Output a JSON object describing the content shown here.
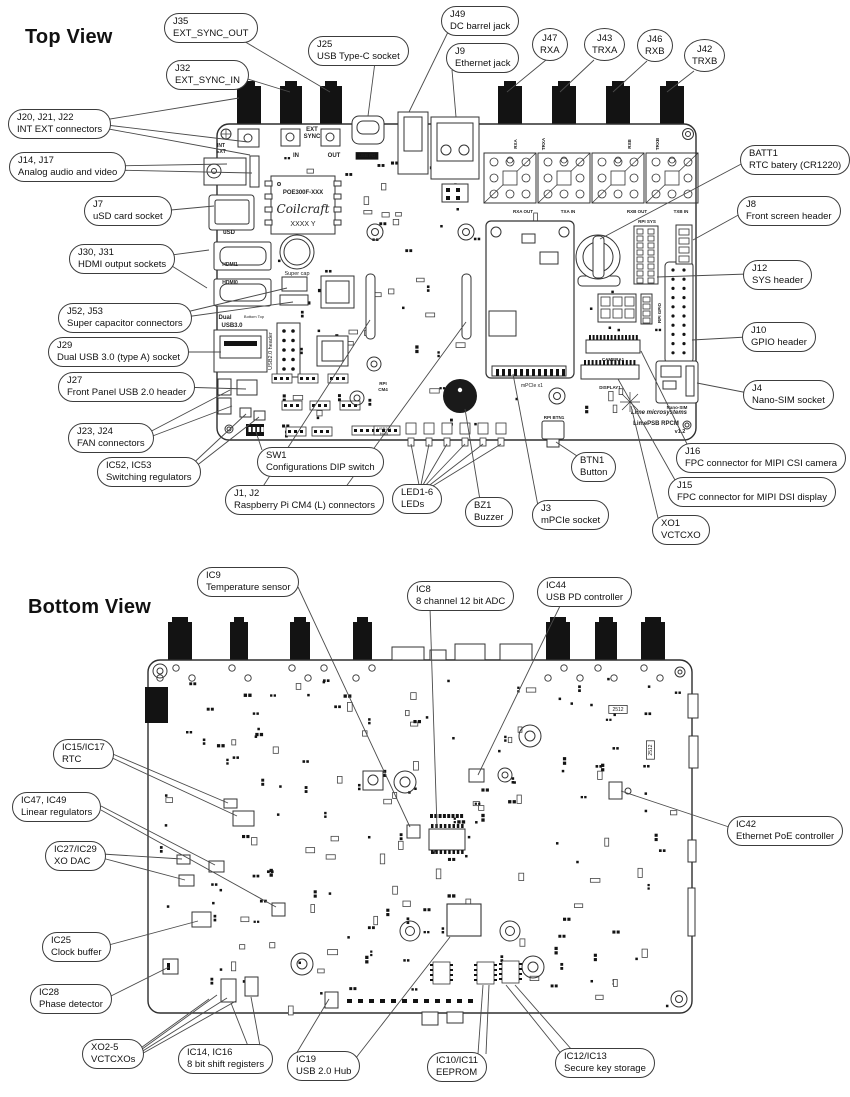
{
  "colors": {
    "ink": "#333333",
    "connector": "#131313",
    "leader": "#4a4a4a",
    "background": "#ffffff"
  },
  "top_view": {
    "heading": "Top View",
    "callouts": [
      {
        "id": "j35",
        "ref": "J35",
        "desc": "EXT_SYNC_OUT",
        "x": 164,
        "y": 13,
        "lines": [
          [
            242,
            40,
            330,
            92
          ]
        ]
      },
      {
        "id": "j32",
        "ref": "J32",
        "desc": "EXT_SYNC_IN",
        "x": 166,
        "y": 60,
        "lines": [
          [
            238,
            76,
            290,
            92
          ]
        ]
      },
      {
        "id": "j25",
        "ref": "J25",
        "desc": "USB Type-C socket",
        "x": 308,
        "y": 36,
        "lines": [
          [
            375,
            62,
            368,
            116
          ]
        ]
      },
      {
        "id": "j49",
        "ref": "J49",
        "desc": "DC barrel jack",
        "x": 441,
        "y": 6,
        "lines": [
          [
            448,
            32,
            409,
            112
          ]
        ]
      },
      {
        "id": "j9",
        "ref": "J9",
        "desc": "Ethernet jack",
        "x": 446,
        "y": 43,
        "lines": [
          [
            452,
            70,
            456,
            117
          ]
        ]
      },
      {
        "id": "j47",
        "ref": "J47",
        "desc": "RXA",
        "round": 1,
        "x": 532,
        "y": 28,
        "lines": [
          [
            546,
            60,
            507,
            92
          ]
        ]
      },
      {
        "id": "j43",
        "ref": "J43",
        "desc": "TRXA",
        "round": 1,
        "x": 584,
        "y": 28,
        "lines": [
          [
            594,
            60,
            560,
            92
          ]
        ]
      },
      {
        "id": "j46",
        "ref": "J46",
        "desc": "RXB",
        "round": 1,
        "x": 637,
        "y": 29,
        "lines": [
          [
            647,
            61,
            613,
            92
          ]
        ]
      },
      {
        "id": "j42",
        "ref": "J42",
        "desc": "TRXB",
        "round": 1,
        "x": 684,
        "y": 39,
        "lines": [
          [
            694,
            71,
            667,
            92
          ]
        ]
      },
      {
        "id": "j20",
        "ref": "J20, J21, J22",
        "desc": "INT EXT connectors",
        "x": 8,
        "y": 109,
        "lines": [
          [
            98,
            121,
            239,
            98
          ],
          [
            98,
            124,
            248,
            142
          ],
          [
            98,
            127,
            250,
            155
          ]
        ]
      },
      {
        "id": "j14",
        "ref": "J14, J17",
        "desc": "Analog audio and video",
        "x": 9,
        "y": 152,
        "lines": [
          [
            110,
            166,
            227,
            164
          ],
          [
            110,
            170,
            252,
            173
          ]
        ]
      },
      {
        "id": "j7",
        "ref": "J7",
        "desc": "uSD card socket",
        "x": 84,
        "y": 196,
        "lines": [
          [
            160,
            211,
            214,
            206
          ]
        ]
      },
      {
        "id": "j30",
        "ref": "J30, J31",
        "desc": "HDMI output sockets",
        "x": 69,
        "y": 244,
        "lines": [
          [
            164,
            256,
            209,
            250
          ],
          [
            164,
            261,
            207,
            288
          ]
        ]
      },
      {
        "id": "j52",
        "ref": "J52, J53",
        "desc": "Super capacitor connectors",
        "x": 58,
        "y": 303,
        "lines": [
          [
            178,
            314,
            287,
            288
          ],
          [
            178,
            318,
            293,
            302
          ]
        ]
      },
      {
        "id": "j29",
        "ref": "J29",
        "desc": "Dual USB 3.0 (type A) socket",
        "x": 48,
        "y": 337,
        "lines": [
          [
            175,
            352,
            221,
            352
          ]
        ]
      },
      {
        "id": "j27",
        "ref": "J27",
        "desc": "Front Panel USB 2.0 header",
        "x": 58,
        "y": 372,
        "lines": [
          [
            179,
            387,
            246,
            389
          ]
        ]
      },
      {
        "id": "j23",
        "ref": "J23, J24",
        "desc": "FAN connectors",
        "x": 68,
        "y": 423,
        "lines": [
          [
            142,
            436,
            230,
            390
          ],
          [
            142,
            440,
            232,
            406
          ]
        ]
      },
      {
        "id": "ic52",
        "ref": "IC52, IC53",
        "desc": "Switching regulators",
        "x": 97,
        "y": 457,
        "lines": [
          [
            186,
            470,
            246,
            414
          ],
          [
            186,
            474,
            259,
            417
          ]
        ]
      },
      {
        "id": "sw1",
        "ref": "SW1",
        "desc": "Configurations DIP switch",
        "x": 257,
        "y": 447,
        "lines": [
          [
            262,
            450,
            256,
            432
          ]
        ]
      },
      {
        "id": "j1",
        "ref": "J1, J2",
        "desc": "Raspberry Pi CM4 (L) connectors",
        "x": 225,
        "y": 485,
        "lines": [
          [
            262,
            488,
            370,
            320
          ],
          [
            345,
            488,
            466,
            322
          ]
        ]
      },
      {
        "id": "led",
        "ref": "LED1-6",
        "desc": "LEDs",
        "x": 392,
        "y": 484,
        "lines": [
          [
            420,
            490,
            411,
            444
          ],
          [
            420,
            490,
            429,
            444
          ],
          [
            420,
            490,
            447,
            444
          ],
          [
            421,
            490,
            465,
            444
          ],
          [
            422,
            491,
            483,
            444
          ],
          [
            423,
            492,
            501,
            444
          ]
        ]
      },
      {
        "id": "bz1",
        "ref": "BZ1",
        "desc": "Buzzer",
        "x": 465,
        "y": 497,
        "lines": [
          [
            480,
            500,
            465,
            409
          ]
        ]
      },
      {
        "id": "j3",
        "ref": "J3",
        "desc": "mPCIe socket",
        "x": 532,
        "y": 500,
        "lines": [
          [
            538,
            506,
            513,
            374
          ]
        ]
      },
      {
        "id": "btn1",
        "ref": "BTN1",
        "desc": "Button",
        "x": 571,
        "y": 452,
        "lines": [
          [
            577,
            456,
            556,
            442
          ]
        ]
      },
      {
        "id": "xo1",
        "ref": "XO1",
        "desc": "VCTCXO",
        "x": 652,
        "y": 515,
        "lines": [
          [
            658,
            518,
            631,
            406
          ]
        ]
      },
      {
        "id": "j16",
        "ref": "J16",
        "desc": "FPC connector for MIPI CSI camera",
        "x": 676,
        "y": 443,
        "lines": [
          [
            688,
            446,
            641,
            351
          ]
        ]
      },
      {
        "id": "j15",
        "ref": "J15",
        "desc": "FPC connector for MIPI DSI display",
        "x": 668,
        "y": 477,
        "lines": [
          [
            675,
            480,
            618,
            379
          ]
        ]
      },
      {
        "id": "batt1",
        "ref": "BATT1",
        "desc": "RTC batery (CR1220)",
        "x": 740,
        "y": 145,
        "lines": [
          [
            745,
            162,
            600,
            239
          ]
        ]
      },
      {
        "id": "j8",
        "ref": "J8",
        "desc": "Front screen header",
        "x": 737,
        "y": 196,
        "lines": [
          [
            742,
            213,
            693,
            240
          ]
        ]
      },
      {
        "id": "j12",
        "ref": "J12",
        "desc": "SYS header",
        "x": 743,
        "y": 260,
        "lines": [
          [
            748,
            274,
            657,
            277
          ]
        ]
      },
      {
        "id": "j10",
        "ref": "J10",
        "desc": "GPIO header",
        "x": 742,
        "y": 322,
        "lines": [
          [
            747,
            337,
            692,
            340
          ]
        ]
      },
      {
        "id": "j4",
        "ref": "J4",
        "desc": "Nano-SIM socket",
        "x": 743,
        "y": 380,
        "lines": [
          [
            748,
            393,
            697,
            383
          ]
        ]
      }
    ],
    "silkscreen": [
      {
        "t": "EXT",
        "x": 312,
        "y": 131,
        "s": 6,
        "b": 1
      },
      {
        "t": "SYNC",
        "x": 312,
        "y": 138,
        "s": 6,
        "b": 1
      },
      {
        "t": "IN",
        "x": 296,
        "y": 157,
        "s": 6,
        "b": 1
      },
      {
        "t": "OUT",
        "x": 334,
        "y": 157,
        "s": 6,
        "b": 1
      },
      {
        "t": "INT",
        "x": 221,
        "y": 147,
        "s": 5,
        "b": 1
      },
      {
        "t": "EXT",
        "x": 221,
        "y": 153,
        "s": 5,
        "b": 1
      },
      {
        "t": "USB PD",
        "x": 367,
        "y": 157,
        "s": 4.5,
        "inv": 1
      },
      {
        "t": "POE300F-XXX",
        "x": 303,
        "y": 194,
        "s": 6,
        "b": 1
      },
      {
        "t": "Coilcraft",
        "x": 303,
        "y": 213,
        "s": 12,
        "script": 1
      },
      {
        "t": "XXXX Y",
        "x": 303,
        "y": 226,
        "s": 7
      },
      {
        "t": "uSD",
        "x": 229,
        "y": 234,
        "s": 6,
        "b": 1
      },
      {
        "t": "HDMI1",
        "x": 230,
        "y": 266,
        "s": 5,
        "b": 1
      },
      {
        "t": "HDMI0",
        "x": 230,
        "y": 284,
        "s": 5,
        "b": 1
      },
      {
        "t": "Super cap",
        "x": 297,
        "y": 275,
        "s": 5.5
      },
      {
        "t": "Dual",
        "x": 225,
        "y": 319,
        "s": 6,
        "b": 1
      },
      {
        "t": "USB3.0",
        "x": 232,
        "y": 327,
        "s": 6,
        "b": 1
      },
      {
        "t": "Bottom Top",
        "x": 254,
        "y": 318,
        "s": 4
      },
      {
        "t": "USB2.0 header",
        "x": 272,
        "y": 351,
        "s": 5.5,
        "rot": -90
      },
      {
        "t": "RPI",
        "x": 383,
        "y": 385,
        "s": 4.5,
        "b": 1
      },
      {
        "t": "CM4",
        "x": 383,
        "y": 391,
        "s": 4.5,
        "b": 1
      },
      {
        "t": "mPCIe x1",
        "x": 532,
        "y": 387,
        "s": 5
      },
      {
        "t": "RPI SYS",
        "x": 647,
        "y": 223,
        "s": 4.5,
        "b": 1
      },
      {
        "t": "RPI GPIO",
        "x": 661,
        "y": 313,
        "s": 4.5,
        "b": 1,
        "rot": -90
      },
      {
        "t": "CAMERA1",
        "x": 613,
        "y": 361,
        "s": 4.5,
        "b": 1
      },
      {
        "t": "DISPLAY1",
        "x": 610,
        "y": 389,
        "s": 4.5,
        "b": 1
      },
      {
        "t": "Nano-SIM",
        "x": 677,
        "y": 409,
        "s": 4.5,
        "b": 1
      },
      {
        "t": "RPI BTN1",
        "x": 554,
        "y": 419,
        "s": 4.5,
        "b": 1
      },
      {
        "t": "RXA",
        "x": 517,
        "y": 144,
        "s": 4.5,
        "b": 1,
        "rot": -90
      },
      {
        "t": "TRXA",
        "x": 545,
        "y": 144,
        "s": 4.5,
        "b": 1,
        "rot": -90
      },
      {
        "t": "RXB",
        "x": 631,
        "y": 144,
        "s": 4.5,
        "b": 1,
        "rot": -90
      },
      {
        "t": "TRXB",
        "x": 659,
        "y": 144,
        "s": 4.5,
        "b": 1,
        "rot": -90
      },
      {
        "t": "RXA OUT",
        "x": 523,
        "y": 213,
        "s": 4.5,
        "b": 1
      },
      {
        "t": "TXA IN",
        "x": 568,
        "y": 213,
        "s": 4.5,
        "b": 1
      },
      {
        "t": "RXB OUT",
        "x": 637,
        "y": 213,
        "s": 4.5,
        "b": 1
      },
      {
        "t": "TXB IN",
        "x": 681,
        "y": 213,
        "s": 4.5,
        "b": 1
      },
      {
        "t": "Lime microsystems",
        "x": 659,
        "y": 414,
        "s": 6,
        "b": 1,
        "i": 1
      },
      {
        "t": "LimePSB RPCM",
        "x": 656,
        "y": 425,
        "s": 6,
        "b": 1
      },
      {
        "t": "v1.2",
        "x": 680,
        "y": 433,
        "s": 5.5,
        "b": 1
      },
      {
        "t": "USB2.0",
        "x": 384,
        "y": 430,
        "s": 4
      },
      {
        "t": "HUB",
        "x": 384,
        "y": 435,
        "s": 4
      }
    ]
  },
  "bottom_view": {
    "heading": "Bottom View",
    "callouts": [
      {
        "id": "ic9",
        "ref": "IC9",
        "desc": "Temperature sensor",
        "x": 197,
        "y": 567,
        "lines": [
          [
            298,
            587,
            410,
            827
          ]
        ]
      },
      {
        "id": "ic8",
        "ref": "IC8",
        "desc": "8 channel 12 bit ADC",
        "x": 407,
        "y": 581,
        "lines": [
          [
            430,
            608,
            437,
            828
          ]
        ]
      },
      {
        "id": "ic44",
        "ref": "IC44",
        "desc": "USB PD controller",
        "x": 537,
        "y": 577,
        "lines": [
          [
            560,
            606,
            478,
            775
          ]
        ]
      },
      {
        "id": "ic15",
        "ref": "IC15/IC17",
        "desc": "RTC",
        "x": 53,
        "y": 739,
        "lines": [
          [
            108,
            752,
            228,
            803
          ],
          [
            108,
            756,
            237,
            816
          ]
        ]
      },
      {
        "id": "ic47",
        "ref": "IC47, IC49",
        "desc": "Linear regulators",
        "x": 12,
        "y": 792,
        "lines": [
          [
            101,
            806,
            215,
            865
          ],
          [
            101,
            810,
            276,
            907
          ]
        ]
      },
      {
        "id": "ic27",
        "ref": "IC27/IC29",
        "desc": "XO DAC",
        "x": 45,
        "y": 841,
        "lines": [
          [
            102,
            854,
            182,
            859
          ],
          [
            102,
            858,
            185,
            880
          ]
        ]
      },
      {
        "id": "ic42",
        "ref": "IC42",
        "desc": "Ethernet PoE controller",
        "x": 727,
        "y": 816,
        "lines": [
          [
            732,
            828,
            621,
            791
          ]
        ]
      },
      {
        "id": "ic25",
        "ref": "IC25",
        "desc": "Clock buffer",
        "x": 42,
        "y": 932,
        "lines": [
          [
            105,
            946,
            198,
            921
          ]
        ]
      },
      {
        "id": "ic28",
        "ref": "IC28",
        "desc": "Phase detector",
        "x": 30,
        "y": 984,
        "lines": [
          [
            107,
            998,
            169,
            967
          ]
        ]
      },
      {
        "id": "xo2",
        "ref": "XO2-5",
        "desc": "VCTCXOs",
        "x": 82,
        "y": 1039,
        "lines": [
          [
            138,
            1050,
            209,
            999
          ],
          [
            138,
            1052,
            217,
            995
          ],
          [
            138,
            1054,
            227,
            998
          ],
          [
            138,
            1056,
            236,
            1001
          ]
        ]
      },
      {
        "id": "ic14",
        "ref": "IC14, IC16",
        "desc": "8 bit shift registers",
        "x": 178,
        "y": 1044,
        "lines": [
          [
            248,
            1046,
            231,
            1003
          ],
          [
            260,
            1046,
            251,
            997
          ]
        ]
      },
      {
        "id": "ic19",
        "ref": "IC19",
        "desc": "USB 2.0 Hub",
        "x": 287,
        "y": 1051,
        "lines": [
          [
            296,
            1054,
            329,
            999
          ],
          [
            352,
            1063,
            450,
            937
          ]
        ]
      },
      {
        "id": "ic10",
        "ref": "IC10/IC11",
        "desc": "EEPROM",
        "x": 427,
        "y": 1052,
        "lines": [
          [
            478,
            1054,
            483,
            985
          ],
          [
            486,
            1054,
            489,
            985
          ]
        ]
      },
      {
        "id": "ic12",
        "ref": "IC12/IC13",
        "desc": "Secure key storage",
        "x": 555,
        "y": 1048,
        "lines": [
          [
            563,
            1056,
            506,
            985
          ],
          [
            572,
            1050,
            515,
            985
          ]
        ]
      }
    ],
    "silkscreen": [
      {
        "t": "2512",
        "x": 618,
        "y": 711,
        "s": 5,
        "box": 1
      },
      {
        "t": "2512",
        "x": 652,
        "y": 750,
        "s": 5,
        "box": 1,
        "rot": -90
      }
    ]
  }
}
